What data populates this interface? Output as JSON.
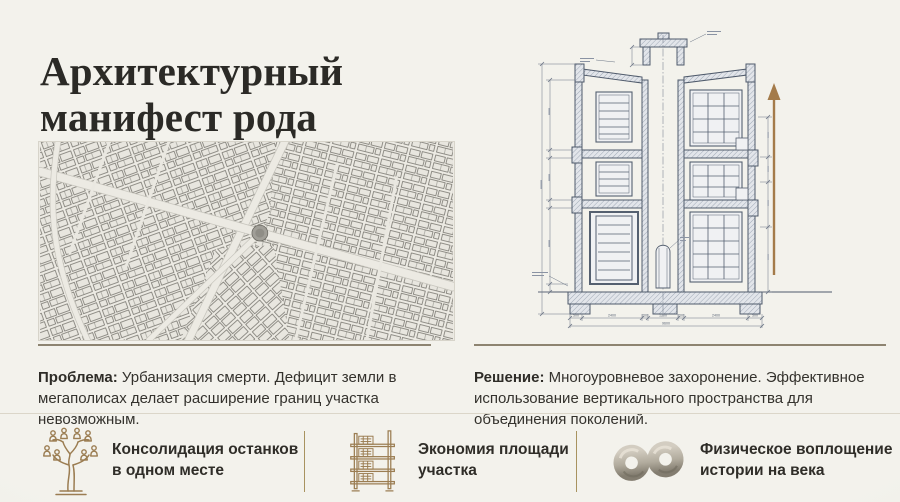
{
  "header": {
    "title_line1": "Архитектурный",
    "title_line2": "манифест рода"
  },
  "left_column": {
    "problem_label": "Проблема:",
    "problem_text": " Урбанизация смерти. Дефицит земли в мегаполисах делает расширение границ участка невозможным."
  },
  "right_column": {
    "solution_label": "Решение:",
    "solution_text": " Многоуровневое захоронение. Эффективное использование вертикального пространства для объединения поколений."
  },
  "drawing": {
    "dim_bottom": [
      "500",
      "2400",
      "200",
      "1200",
      "200",
      "2400",
      "500"
    ],
    "dim_total": "9600"
  },
  "benefits": [
    {
      "icon": "family-tree-icon",
      "line1": "Консолидация останков",
      "line2": "в одном месте"
    },
    {
      "icon": "shelf-rack-icon",
      "line1": "Экономия площади",
      "line2": "участка"
    },
    {
      "icon": "infinity-stone-icon",
      "line1": "Физическое воплощение",
      "line2": "истории на века"
    }
  ],
  "colors": {
    "background": "#f2f1eb",
    "title_ink": "#2b2a26",
    "body_ink": "#33312c",
    "divider_dark": "#8d8471",
    "divider_light": "#dbd6c9",
    "divider_gold": "#a8935f",
    "icon_gold": "#9b7d52",
    "blueprint_ink": "#556070",
    "arrow_brown": "#a47b4a"
  }
}
